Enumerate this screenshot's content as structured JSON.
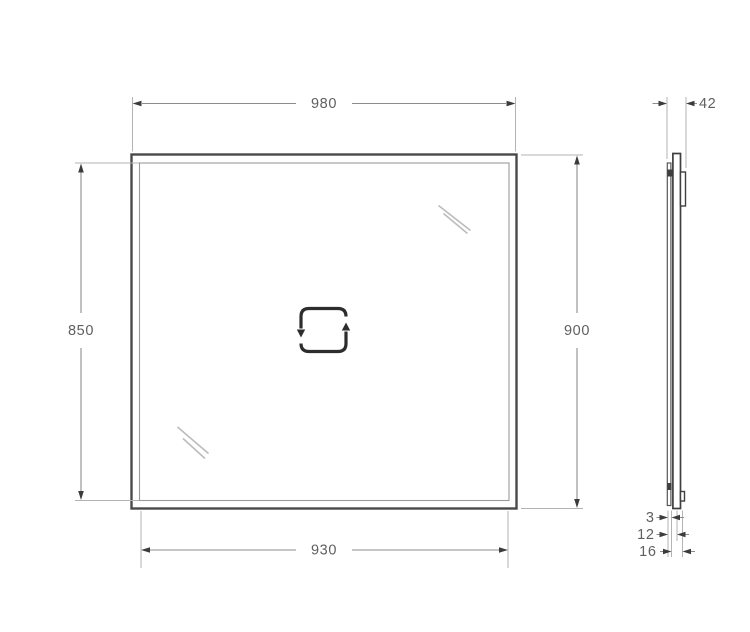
{
  "drawing": {
    "type": "technical-drawing",
    "subject": "rectangular mirror, front view and side profile",
    "views": {
      "front": {
        "labels": {
          "top_width": "980",
          "left_height": "850",
          "right_height": "900",
          "bottom_width": "930"
        }
      },
      "side": {
        "labels": {
          "depth": "42",
          "detail_top": "3",
          "detail_middle": "12",
          "detail_bottom": "16"
        }
      }
    },
    "icons": {
      "center": "rotate-square-icon",
      "glass_marks": "glass-shine-icon"
    },
    "colors": {
      "background": "#ffffff",
      "frame_stroke": "#4a4a4a",
      "inner_stroke": "#9a9a9a",
      "dimension_line": "#8c8c8c",
      "extension_line": "#b3b3b3",
      "arrow": "#3c3c3c",
      "text": "#5f5f5f",
      "icon": "#2d2d2d",
      "shine": "#bcbcbc"
    }
  }
}
